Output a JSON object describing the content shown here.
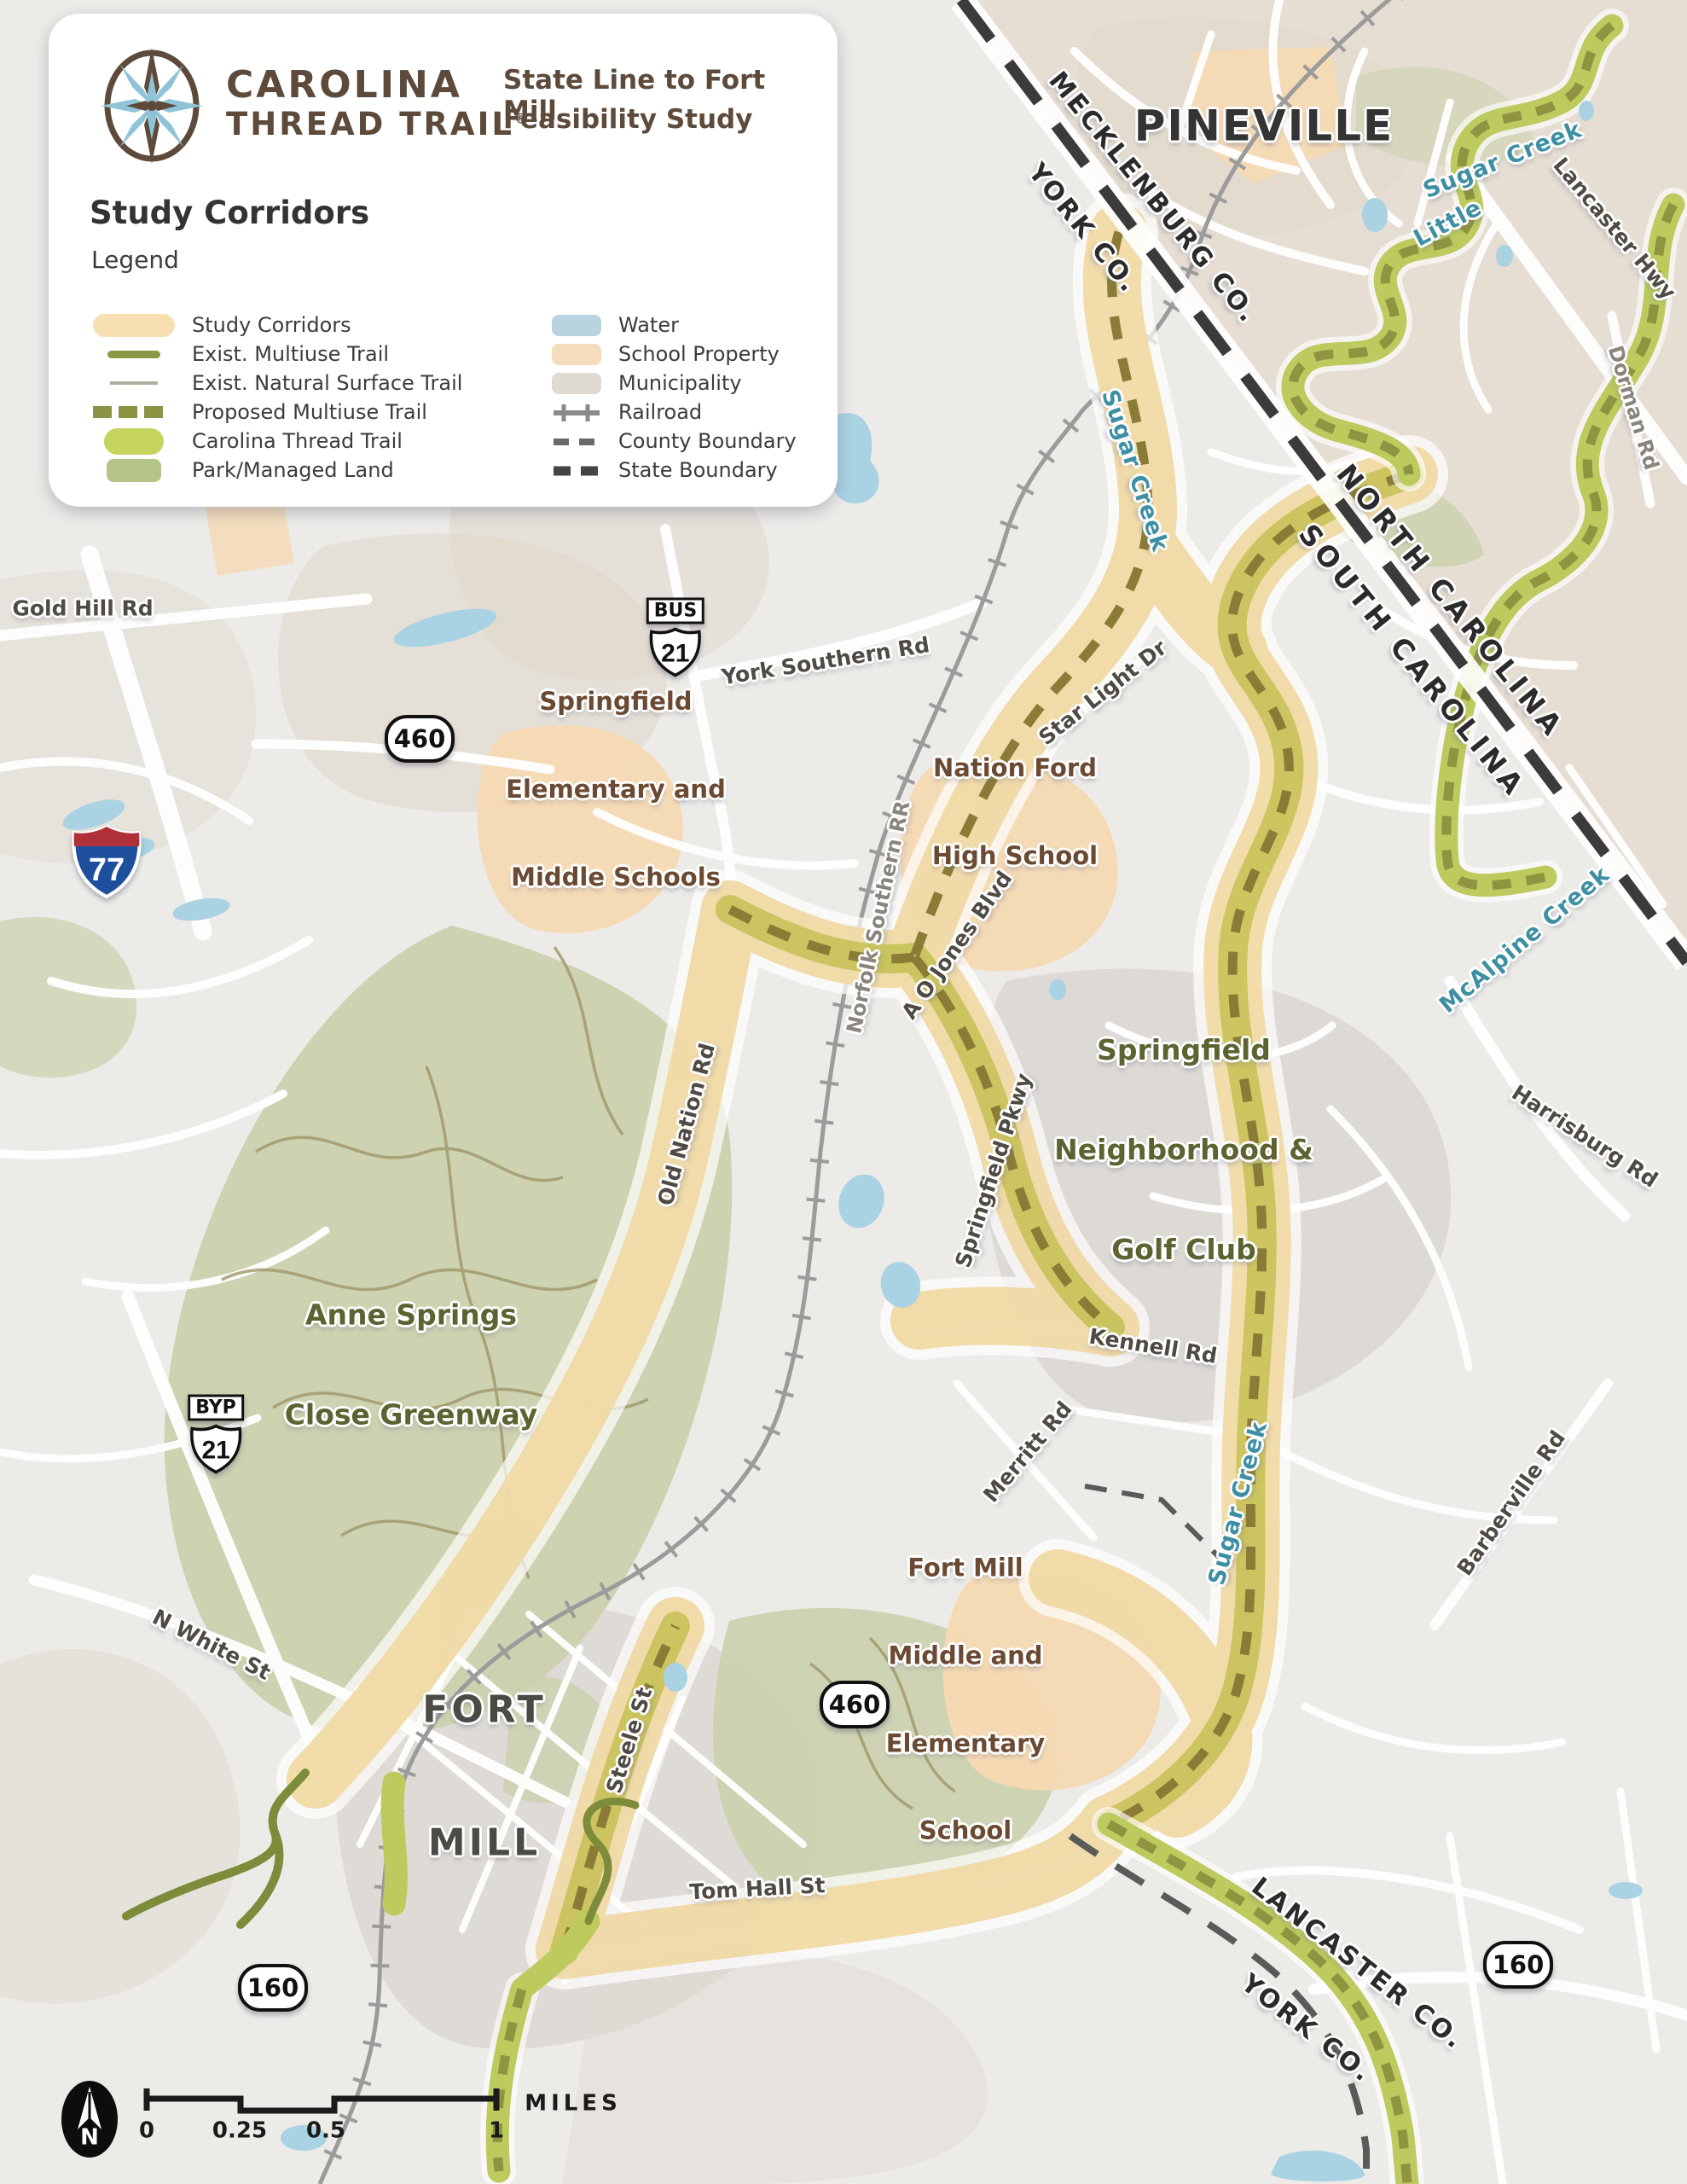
{
  "header": {
    "brand_line1": "CAROLINA",
    "brand_line2": "THREAD TRAIL",
    "brand_reg": "®",
    "title_line1": "State Line to Fort Mill",
    "title_line2": "Feasibility Study",
    "panel_title": "Study Corridors",
    "legend_label": "Legend"
  },
  "legend": {
    "items_left": [
      {
        "label": "Study Corridors"
      },
      {
        "label": "Exist. Multiuse Trail"
      },
      {
        "label": "Exist. Natural Surface Trail"
      },
      {
        "label": "Proposed Multiuse Trail"
      },
      {
        "label": "Carolina Thread Trail"
      },
      {
        "label": "Park/Managed Land"
      }
    ],
    "items_right": [
      {
        "label": "Water"
      },
      {
        "label": "School Property"
      },
      {
        "label": "Municipality"
      },
      {
        "label": "Railroad"
      },
      {
        "label": "County Boundary"
      },
      {
        "label": "State Boundary"
      }
    ]
  },
  "labels": {
    "pineville": "PINEVILLE",
    "sugar_creek_top": "Sugar Creek",
    "little": "Little",
    "lancaster_hwy": "Lancaster Hwy",
    "dorman_rd": "Dorman Rd",
    "mecklenburg_co": "MECKLENBURG CO.",
    "york_co_top": "YORK CO.",
    "north_carolina": "NORTH CAROLINA",
    "south_carolina": "SOUTH CAROLINA",
    "sugar_creek_north": "Sugar Creek",
    "gold_hill_rd": "Gold Hill Rd",
    "york_southern_rd": "York Southern Rd",
    "star_light_dr": "Star Light Dr",
    "springfield_schools": {
      "lines": [
        "Springfield",
        "Elementary and",
        "Middle Schools"
      ]
    },
    "nation_ford": {
      "lines": [
        "Nation Ford",
        "High School"
      ]
    },
    "norfolk_southern": "Norfolk Southern RR",
    "ao_jones": "A O Jones Blvd",
    "mcalpine_creek": "McAlpine Creek",
    "harrisburg_rd": "Harrisburg Rd",
    "old_nation_rd": "Old Nation Rd",
    "springfield_pkwy": "Springfield Pkwy",
    "springfield_golf": {
      "lines": [
        "Springfield",
        "Neighborhood &",
        "Golf Club"
      ]
    },
    "anne_springs": {
      "lines": [
        "Anne Springs",
        "Close Greenway"
      ]
    },
    "kennell_rd": "Kennell Rd",
    "merritt_rd": "Merritt Rd",
    "sugar_creek_south": "Sugar Creek",
    "barberville_rd": "Barberville Rd",
    "n_white_st": "N White St",
    "fort_mill": {
      "lines": [
        "FORT",
        "MILL"
      ]
    },
    "steele_st": "Steele St",
    "fort_mill_school": {
      "lines": [
        "Fort Mill",
        "Middle and",
        "Elementary",
        "School"
      ]
    },
    "tom_hall_st": "Tom Hall St",
    "lancaster_co": "LANCASTER CO.",
    "york_co_bottom": "YORK CO."
  },
  "shields": {
    "i77": "77",
    "bus21": {
      "banner": "BUS",
      "number": "21"
    },
    "byp21": {
      "banner": "BYP",
      "number": "21"
    },
    "r460": "460",
    "r160": "160"
  },
  "scalebar": {
    "ticks": [
      "0",
      "0.25",
      "0.5",
      "1"
    ],
    "unit": "MILES"
  },
  "north_arrow": {
    "letter": "N"
  },
  "colors": {
    "study_corridor": "#f0d9a4",
    "ctt_green": "#bcca5e",
    "multiuse_olive": "#7c8c3a",
    "proposed_dash": "#8a7c36",
    "park": "#cbd1ad",
    "water": "#a9d2e2",
    "school_property": "#f5d9b3",
    "municipality": "#dcd8d2",
    "creek_label": "#3e8fa3",
    "brand_brown": "#5d4a3a"
  }
}
